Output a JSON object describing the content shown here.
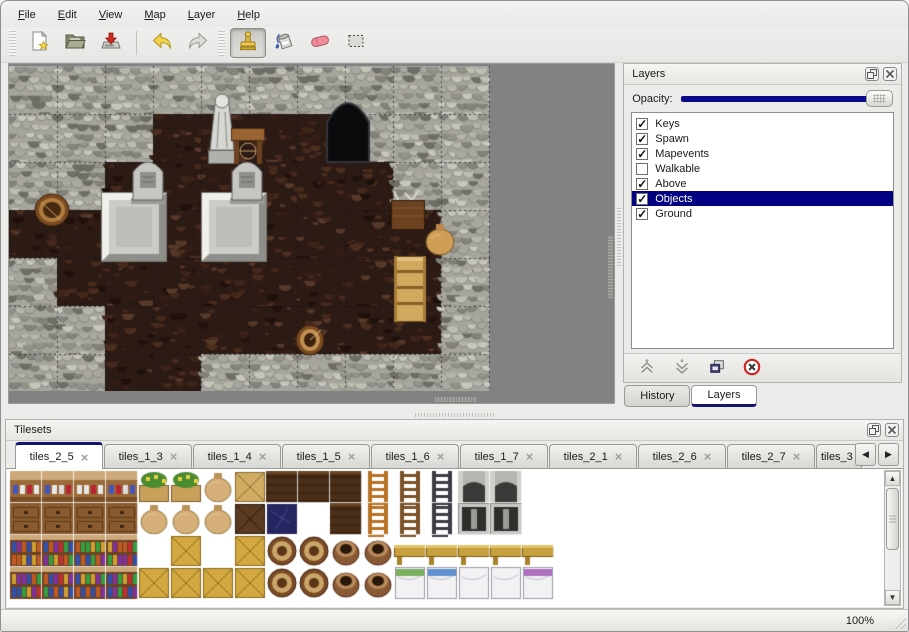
{
  "menu_bar": {
    "items": [
      {
        "label": "File"
      },
      {
        "label": "Edit"
      },
      {
        "label": "View"
      },
      {
        "label": "Map"
      },
      {
        "label": "Layer"
      },
      {
        "label": "Help"
      }
    ]
  },
  "toolbar": {
    "groups": [
      {
        "buttons": [
          {
            "name": "new-file",
            "icon": "new-file-icon",
            "active": false
          },
          {
            "name": "open-file",
            "icon": "open-folder-icon",
            "active": false
          },
          {
            "name": "save-file",
            "icon": "save-icon",
            "active": false
          },
          {
            "separator": true
          },
          {
            "name": "undo",
            "icon": "undo-icon",
            "active": false
          },
          {
            "name": "redo",
            "icon": "redo-icon",
            "active": false
          }
        ]
      },
      {
        "buttons": [
          {
            "name": "stamp-tool",
            "icon": "stamp-tool-icon",
            "active": true
          },
          {
            "name": "fill-tool",
            "icon": "fill-tool-icon",
            "active": false
          },
          {
            "name": "eraser-tool",
            "icon": "eraser-tool-icon",
            "active": false
          },
          {
            "name": "selection-tool",
            "icon": "selection-tool-icon",
            "active": false
          }
        ]
      }
    ]
  },
  "map_view": {
    "tile_size": 48,
    "width": 481,
    "height": 325,
    "grid": [
      "WWWWWWWWWW",
      "WWWFFFFWWW",
      "WWFFFFFFWW",
      "FFFFFFFFFW",
      "WFFFFFFFFW",
      "WWFFFFFFFW",
      "WWFFWWWWWW"
    ],
    "objects": [
      {
        "type": "platform",
        "x": 92,
        "y": 126,
        "w": 66,
        "h": 70
      },
      {
        "type": "platform",
        "x": 192,
        "y": 126,
        "w": 66,
        "h": 70
      },
      {
        "type": "gravestone",
        "x": 124,
        "y": 94,
        "w": 30,
        "h": 44
      },
      {
        "type": "gravestone",
        "x": 223,
        "y": 94,
        "w": 30,
        "h": 44
      },
      {
        "type": "cave",
        "x": 318,
        "y": 30,
        "w": 42,
        "h": 66
      },
      {
        "type": "statue",
        "x": 196,
        "y": 26,
        "w": 34,
        "h": 72
      },
      {
        "type": "table",
        "x": 222,
        "y": 62,
        "w": 34,
        "h": 36
      },
      {
        "type": "basket",
        "x": 26,
        "y": 128,
        "w": 34,
        "h": 32
      },
      {
        "type": "crate",
        "x": 382,
        "y": 124,
        "w": 34,
        "h": 40
      },
      {
        "type": "sack",
        "x": 416,
        "y": 156,
        "w": 30,
        "h": 34
      },
      {
        "type": "shelf",
        "x": 385,
        "y": 190,
        "w": 32,
        "h": 66
      },
      {
        "type": "barrel",
        "x": 287,
        "y": 258,
        "w": 28,
        "h": 32
      }
    ]
  },
  "layers_panel": {
    "title": "Layers",
    "opacity_label": "Opacity:",
    "opacity_percent": 100,
    "layers": [
      {
        "name": "Keys",
        "checked": true,
        "selected": false
      },
      {
        "name": "Spawn",
        "checked": true,
        "selected": false
      },
      {
        "name": "Mapevents",
        "checked": true,
        "selected": false
      },
      {
        "name": "Walkable",
        "checked": false,
        "selected": false
      },
      {
        "name": "Above",
        "checked": true,
        "selected": false
      },
      {
        "name": "Objects",
        "checked": true,
        "selected": true
      },
      {
        "name": "Ground",
        "checked": true,
        "selected": false
      }
    ],
    "buttons": [
      {
        "name": "move-layer-up",
        "icon": "move-layer-up-icon"
      },
      {
        "name": "move-layer-down",
        "icon": "move-layer-down-icon"
      },
      {
        "name": "duplicate-layer",
        "icon": "duplicate-layer-icon"
      },
      {
        "name": "delete-layer",
        "icon": "delete-layer-icon"
      }
    ],
    "tabs": [
      {
        "label": "History",
        "active": false
      },
      {
        "label": "Layers",
        "active": true
      }
    ]
  },
  "tilesets_panel": {
    "title": "Tilesets",
    "tabs": [
      {
        "label": "tiles_2_5",
        "active": true
      },
      {
        "label": "tiles_1_3",
        "active": false
      },
      {
        "label": "tiles_1_4",
        "active": false
      },
      {
        "label": "tiles_1_5",
        "active": false
      },
      {
        "label": "tiles_1_6",
        "active": false
      },
      {
        "label": "tiles_1_7",
        "active": false
      },
      {
        "label": "tiles_2_1",
        "active": false
      },
      {
        "label": "tiles_2_6",
        "active": false
      },
      {
        "label": "tiles_2_7",
        "active": false
      },
      {
        "label": "tiles_3",
        "active": false,
        "truncated": true
      }
    ],
    "scroll_left_icon": "scroll-left-icon",
    "scroll_right_icon": "scroll-right-icon",
    "tile_size": 32,
    "grid": [
      "ssssppkxDDDlmngg.",
      "ttttkkkXB.DlmnGG.",
      "bbbb.y.yoovveeeee",
      "bbbbyyyyoovv12ww3"
    ]
  },
  "status_bar": {
    "zoom_level": "100%"
  },
  "colors": {
    "selection_navy": "#000080",
    "opacity_slider_fill": "#0a0a86",
    "tab_accent_navy": "#14146e",
    "map_background": "#828282",
    "delete_red": "#cc2222"
  }
}
